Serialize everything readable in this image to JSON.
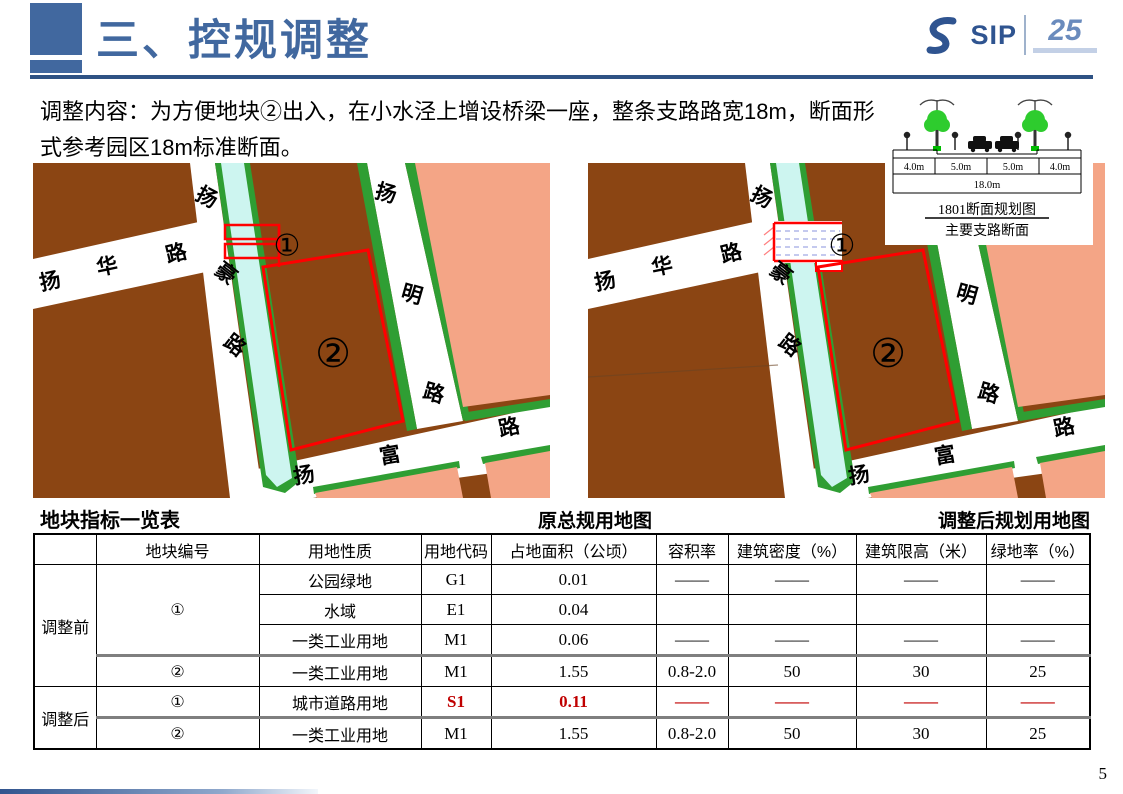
{
  "header": {
    "title": "三、控规调整",
    "logo_sip": "SIP",
    "logo_25": "25"
  },
  "description": "调整内容：为方便地块②出入，在小水泾上增设桥梁一座，整条支路路宽18m，断面形式参考园区18m标准断面。",
  "section_diagram": {
    "dims": [
      "4.0m",
      "5.0m",
      "5.0m",
      "4.0m"
    ],
    "total": "18.0m",
    "title": "1801断面规划图",
    "subtitle": "主要支路断面"
  },
  "maps": {
    "left_caption": "原总规用地图",
    "right_caption": "调整后规划用地图",
    "road_names": [
      "扬华路",
      "扬豪路",
      "扬明路",
      "扬富路"
    ],
    "road_labels": [
      {
        "ch": "扬",
        "x": 17,
        "y": 118,
        "rot": -12
      },
      {
        "ch": "华",
        "x": 74,
        "y": 103,
        "rot": -12
      },
      {
        "ch": "路",
        "x": 143,
        "y": 90,
        "rot": -14
      },
      {
        "ch": "扬",
        "x": 174,
        "y": 34,
        "rot": 28
      },
      {
        "ch": "豪",
        "x": 193,
        "y": 110,
        "rot": 38
      },
      {
        "ch": "路",
        "x": 202,
        "y": 182,
        "rot": 38
      },
      {
        "ch": "扬",
        "x": 353,
        "y": 30,
        "rot": 16
      },
      {
        "ch": "明",
        "x": 379,
        "y": 131,
        "rot": 16
      },
      {
        "ch": "路",
        "x": 401,
        "y": 230,
        "rot": 16
      },
      {
        "ch": "扬",
        "x": 271,
        "y": 312,
        "rot": -10
      },
      {
        "ch": "富",
        "x": 357,
        "y": 292,
        "rot": -10
      },
      {
        "ch": "路",
        "x": 476,
        "y": 264,
        "rot": -12
      }
    ],
    "parcel_labels": [
      {
        "t": "①",
        "x": 254,
        "y": 82,
        "size": 30
      },
      {
        "t": "②",
        "x": 300,
        "y": 190,
        "size": 40
      }
    ],
    "colors": {
      "industrial_brown": "#8B4513",
      "residential_pink": "#F4A586",
      "green_strip": "#2F9E33",
      "river_cyan": "#CDF5F0",
      "road_white": "#FFFFFF",
      "boundary_red": "#FF0000"
    }
  },
  "table": {
    "title": "地块指标一览表",
    "headers": [
      "",
      "地块编号",
      "用地性质",
      "用地代码",
      "占地面积（公顷）",
      "容积率",
      "建筑密度（%）",
      "建筑限高（米）",
      "绿地率（%）"
    ],
    "sections": [
      {
        "label": "调整前",
        "rows": [
          {
            "plot": "①",
            "plot_rowspan": 3,
            "cells": [
              "公园绿地",
              "G1",
              "0.01",
              "——",
              "——",
              "——",
              "——"
            ]
          },
          {
            "cells": [
              "水域",
              "E1",
              "0.04",
              "",
              "",
              "",
              ""
            ]
          },
          {
            "cells": [
              "一类工业用地",
              "M1",
              "0.06",
              "——",
              "——",
              "——",
              "——"
            ]
          },
          {
            "plot": "②",
            "cells": [
              "一类工业用地",
              "M1",
              "1.55",
              "0.8-2.0",
              "50",
              "30",
              "25"
            ]
          }
        ]
      },
      {
        "label": "调整后",
        "rows": [
          {
            "plot": "①",
            "red": true,
            "cells": [
              "城市道路用地",
              "S1",
              "0.11",
              "——",
              "——",
              "——",
              "——"
            ]
          },
          {
            "plot": "②",
            "cells": [
              "一类工业用地",
              "M1",
              "1.55",
              "0.8-2.0",
              "50",
              "30",
              "25"
            ]
          }
        ]
      }
    ],
    "highlight_color": "#C00000"
  },
  "page_number": "5"
}
